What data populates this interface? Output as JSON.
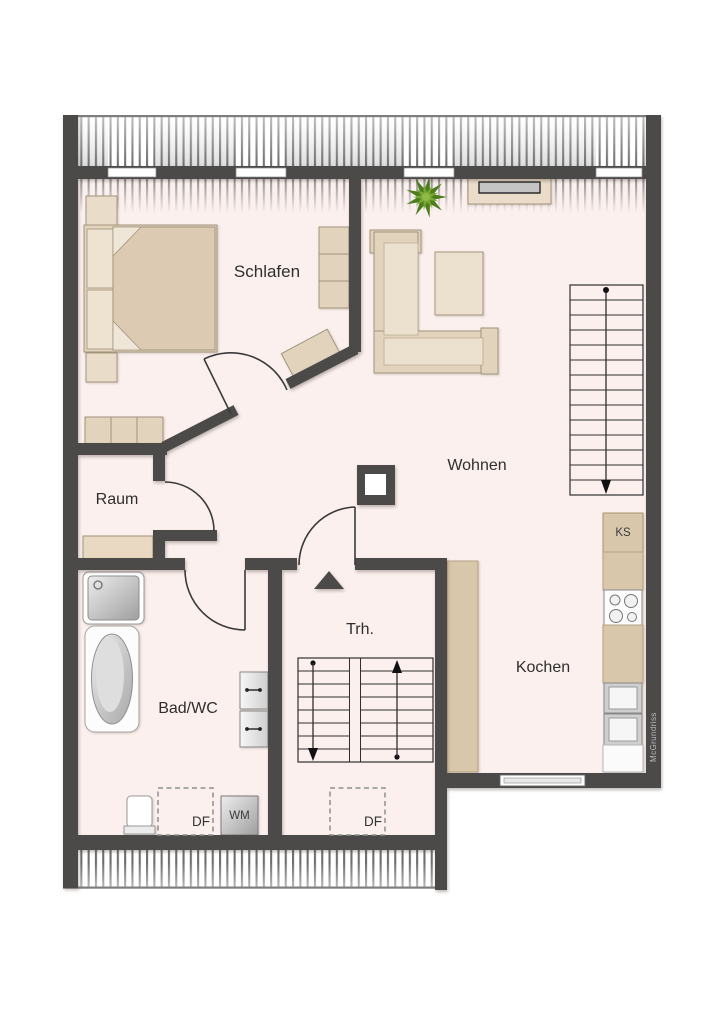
{
  "plan": {
    "type": "floorplan",
    "rooms": [
      {
        "id": "schlafen",
        "label": "Schlafen"
      },
      {
        "id": "raum",
        "label": "Raum"
      },
      {
        "id": "wohnen",
        "label": "Wohnen"
      },
      {
        "id": "trh",
        "label": "Trh."
      },
      {
        "id": "bad_wc",
        "label": "Bad/WC"
      },
      {
        "id": "kochen",
        "label": "Kochen"
      }
    ],
    "markers": {
      "roof_window_bad": "DF",
      "roof_window_trh": "DF",
      "washing_machine": "WM",
      "fridge": "KS"
    },
    "watermark": "McGrundriss",
    "colors": {
      "wall": "#4b4a48",
      "floor": "#fbf0ee",
      "furniture": "#e2d3bd",
      "counter": "#d8c7ab",
      "plant_green": "#5c8f1e",
      "label_text": "#2e2e2e"
    }
  }
}
